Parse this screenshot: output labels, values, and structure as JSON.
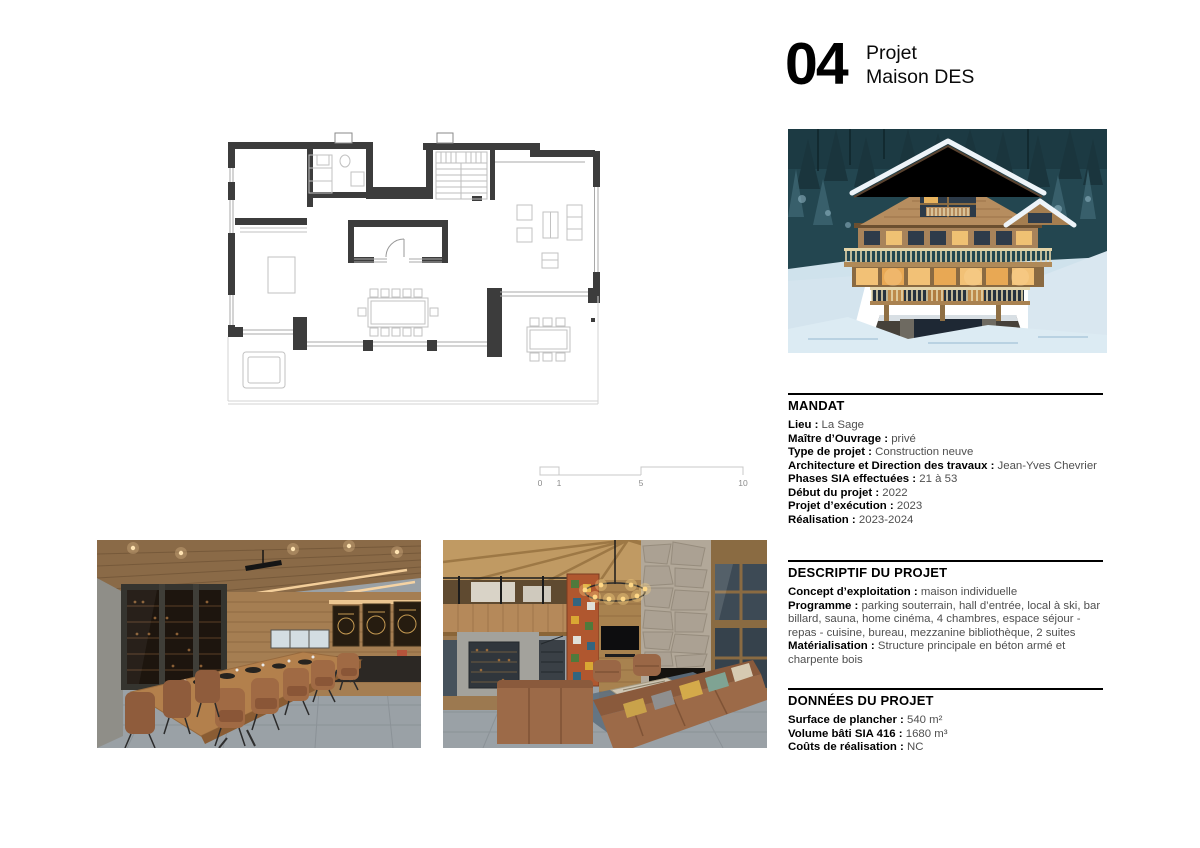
{
  "header": {
    "number": "04",
    "title1": "Projet",
    "title2": "Maison DES"
  },
  "scalebar": {
    "ticks": [
      "0",
      "1",
      "5",
      "10"
    ]
  },
  "sections": {
    "mandat": {
      "title": "MANDAT",
      "rows": [
        {
          "label": "Lieu :",
          "value": "La Sage"
        },
        {
          "label": "Maître d’Ouvrage :",
          "value": "privé"
        },
        {
          "label": "Type de projet :",
          "value": "Construction neuve"
        },
        {
          "label": "Architecture et Direction des travaux :",
          "value": "Jean-Yves Chevrier"
        },
        {
          "label": "Phases SIA effectuées :",
          "value": "21 à 53"
        },
        {
          "label": "Début du projet :",
          "value": "2022"
        },
        {
          "label": "Projet d’exécution :",
          "value": "2023"
        },
        {
          "label": "Réalisation :",
          "value": "2023-2024"
        }
      ]
    },
    "descriptif": {
      "title": "DESCRIPTIF DU PROJET",
      "rows": [
        {
          "label": "Concept d’exploitation :",
          "value": "maison individuelle"
        },
        {
          "label": "Programme :",
          "value": "parking souterrain, hall d’entrée, local à ski, bar billard, sauna, home cinéma, 4 chambres, espace séjour - repas - cuisine, bureau, mezzanine bibliothèque, 2 suites"
        },
        {
          "label": "Matérialisation :",
          "value": "Structure principale en béton armé et charpente bois"
        }
      ]
    },
    "donnees": {
      "title": "DONNÉES DU PROJET",
      "rows": [
        {
          "label": "Surface de plancher :",
          "value": "540 m²"
        },
        {
          "label": "Volume bâti SIA 416 :",
          "value": "1680 m³"
        },
        {
          "label": "Coûts de réalisation :",
          "value": "NC"
        }
      ]
    }
  },
  "images": {
    "floor_plan": "ground-floor-plan",
    "exterior": "chalet-exterior-winter-dusk",
    "dining": "dining-room-long-wood-table",
    "living": "living-room-double-height-stone-fireplace"
  },
  "colors": {
    "ink": "#000000",
    "value_text": "#4f4f4f",
    "plan_wall": "#3c3c3c",
    "plan_thin": "#b9b9b9",
    "night_forest": "#234650",
    "snow": "#d4e4ee",
    "wood": "#a8835a",
    "warm_light": "#f2c176",
    "leather": "#9c6a48"
  }
}
